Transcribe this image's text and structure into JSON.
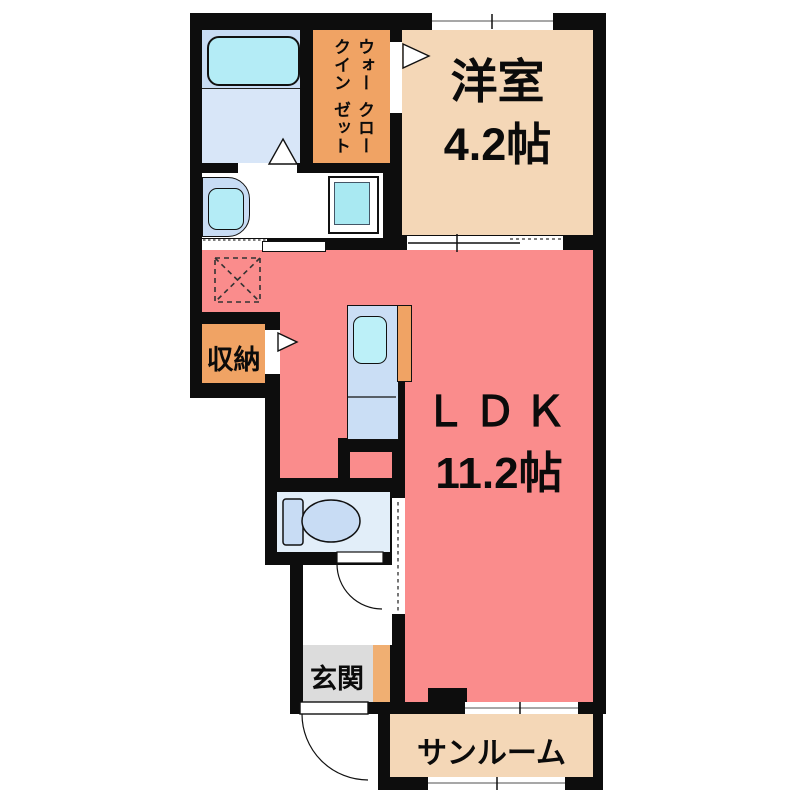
{
  "title": "floor-plan",
  "colors": {
    "wall": "#0d0d0d",
    "ldk": "#FA8C8C",
    "tatami_room": "#F4D7B7",
    "sunroom_floor": "#F4D7B7",
    "closet_orange": "#F0A364",
    "entry_gray": "#DCDCDC",
    "entry_cabinet": "#F0AF72",
    "bath_upper": "#C8DCF4",
    "bath_lower": "#D8E6F8",
    "fixture_blue": "#C8DCF4",
    "tub_cyan": "#B4ECF6",
    "washer_cyan": "#A9E9F2",
    "toilet_room": "#E2EEF9",
    "kitchen_counter": "#CADEF5",
    "sink_cyan": "#BCF0F8"
  },
  "rooms": {
    "western_room": {
      "label": "洋室",
      "size": "4.2帖"
    },
    "ldk": {
      "label": "ＬＤＫ",
      "size": "11.2帖"
    },
    "walk_in_closet": {
      "line1": "ウォークイン",
      "line2": "クローゼット"
    },
    "storage": {
      "label": "収納"
    },
    "entrance": {
      "label": "玄関"
    },
    "sunroom": {
      "label": "サンルーム"
    }
  }
}
